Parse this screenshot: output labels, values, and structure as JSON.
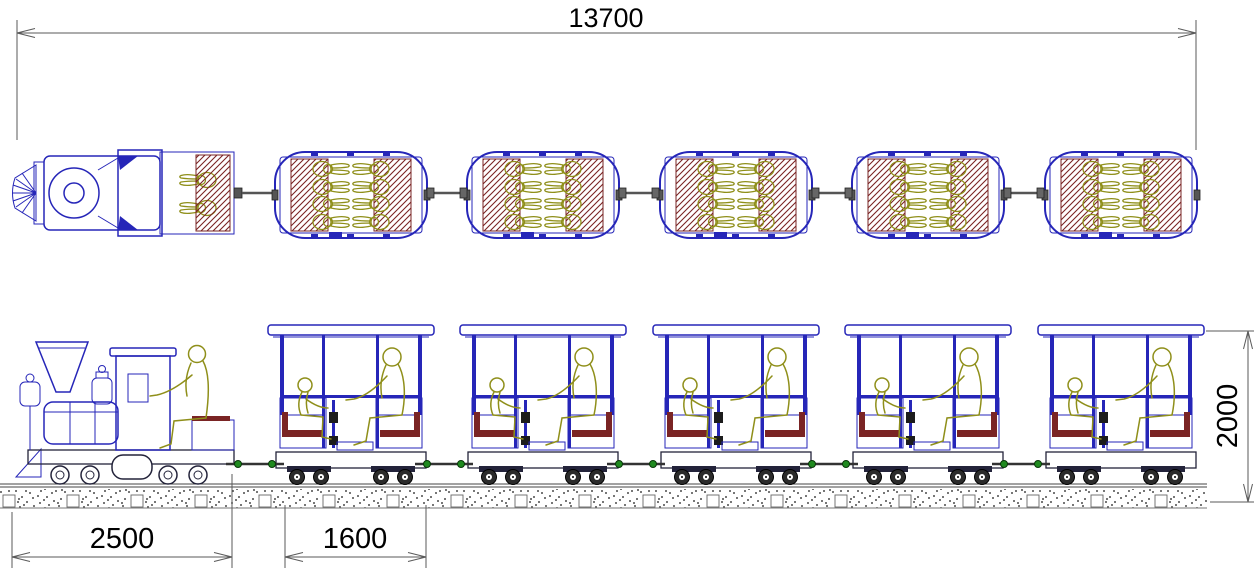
{
  "dimensions": {
    "total_length": "13700",
    "locomotive_length": "2500",
    "carriage_length": "1600",
    "train_height": "2000"
  },
  "train": {
    "carriage_count": 5,
    "plan_passengers_per_carriage": 8,
    "side_passengers_per_carriage": 2,
    "locomotive_crew": 2
  },
  "colors": {
    "line-blue": "#2626b8",
    "figure-olive": "#8f8f1a",
    "seat-maroon": "#7a2424",
    "hatch-dark": "#3c3c4e",
    "dim-line": "#5a5a5a",
    "dim-text": "#000000",
    "coupler-green": "#1f8a1f",
    "ballast-dot": "#4b4b4b",
    "background": "#ffffff"
  }
}
